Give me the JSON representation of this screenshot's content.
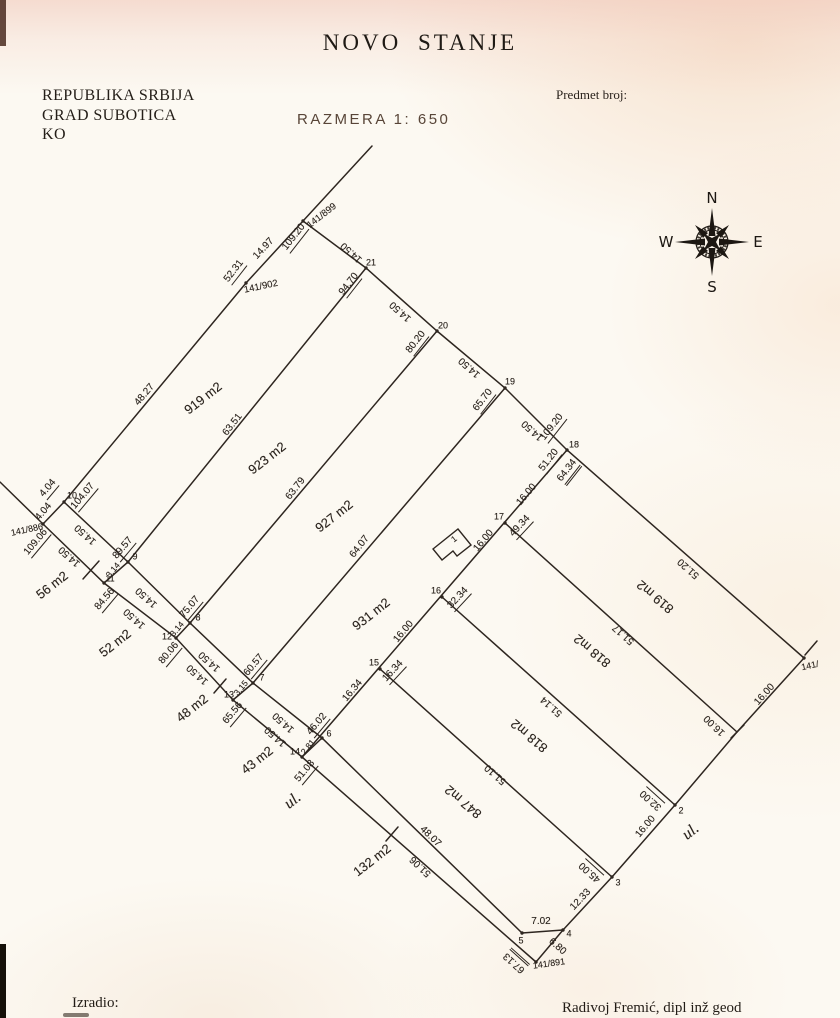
{
  "header": {
    "title": "NOVO STANJE",
    "region_lines": [
      "REPUBLIKA SRBIJA",
      "GRAD SUBOTICA",
      "KO"
    ],
    "scale_label": "RAZMERA 1:  650",
    "case_label": "Predmet broj:"
  },
  "compass": {
    "n": "N",
    "e": "E",
    "s": "S",
    "w": "W"
  },
  "footer": {
    "prepared_by_label": "Izradio:",
    "surveyor": "Radivoj Fremić, dipl inž geod"
  },
  "plan": {
    "ink": "#2e2620",
    "segments": [
      {
        "pts": [
          [
            372,
            146
          ],
          [
            303,
            221
          ],
          [
            246,
            283
          ],
          [
            64,
            502
          ]
        ]
      },
      {
        "pts": [
          [
            303,
            221
          ],
          [
            366,
            268
          ],
          [
            437,
            331
          ],
          [
            505,
            388
          ],
          [
            567,
            450
          ],
          [
            804,
            658
          ]
        ]
      },
      {
        "pts": [
          [
            804,
            658
          ],
          [
            737,
            732
          ],
          [
            675,
            805
          ],
          [
            612,
            877
          ],
          [
            563,
            930
          ],
          [
            536,
            962
          ]
        ]
      },
      {
        "pts": [
          [
            522,
            933
          ],
          [
            563,
            930
          ]
        ]
      },
      {
        "pts": [
          [
            366,
            268
          ],
          [
            128,
            562
          ]
        ]
      },
      {
        "pts": [
          [
            437,
            331
          ],
          [
            190,
            623
          ]
        ]
      },
      {
        "pts": [
          [
            505,
            388
          ],
          [
            253,
            683
          ]
        ]
      },
      {
        "pts": [
          [
            567,
            450
          ],
          [
            302,
            757
          ]
        ]
      },
      {
        "pts": [
          [
            505,
            523
          ],
          [
            737,
            732
          ]
        ]
      },
      {
        "pts": [
          [
            442,
            597
          ],
          [
            675,
            805
          ]
        ]
      },
      {
        "pts": [
          [
            380,
            669
          ],
          [
            612,
            877
          ]
        ]
      },
      {
        "pts": [
          [
            64,
            502
          ],
          [
            128,
            562
          ],
          [
            190,
            623
          ],
          [
            253,
            683
          ],
          [
            322,
            738
          ],
          [
            522,
            933
          ]
        ]
      },
      {
        "pts": [
          [
            0,
            482
          ],
          [
            43,
            524
          ],
          [
            104,
            583
          ],
          [
            176,
            638
          ],
          [
            233,
            700
          ],
          [
            302,
            757
          ],
          [
            536,
            962
          ]
        ]
      },
      {
        "pts": [
          [
            64,
            502
          ],
          [
            43,
            524
          ]
        ]
      },
      {
        "pts": [
          [
            128,
            562
          ],
          [
            104,
            583
          ]
        ]
      },
      {
        "pts": [
          [
            190,
            623
          ],
          [
            176,
            638
          ]
        ]
      },
      {
        "pts": [
          [
            253,
            683
          ],
          [
            233,
            700
          ]
        ]
      },
      {
        "pts": [
          [
            322,
            738
          ],
          [
            302,
            757
          ]
        ]
      }
    ],
    "ticks": [
      [
        99,
        561,
        83,
        579
      ],
      [
        226,
        679,
        214,
        693
      ],
      [
        398,
        827,
        386,
        841
      ],
      [
        817,
        641,
        805,
        655
      ],
      [
        744,
        725,
        731,
        738
      ]
    ],
    "points": [
      [
        303,
        221
      ],
      [
        246,
        283
      ],
      [
        366,
        268
      ],
      [
        437,
        331
      ],
      [
        505,
        388
      ],
      [
        567,
        450
      ],
      [
        505,
        523
      ],
      [
        442,
        597
      ],
      [
        380,
        669
      ],
      [
        302,
        757
      ],
      [
        233,
        700
      ],
      [
        176,
        638
      ],
      [
        104,
        583
      ],
      [
        64,
        502
      ],
      [
        43,
        524
      ],
      [
        128,
        562
      ],
      [
        190,
        623
      ],
      [
        253,
        683
      ],
      [
        322,
        738
      ],
      [
        522,
        933
      ],
      [
        563,
        930
      ],
      [
        536,
        962
      ],
      [
        612,
        877
      ],
      [
        675,
        805
      ],
      [
        804,
        658
      ]
    ],
    "house": {
      "points": "433,549 458,529 471,545 457,556 453,551 442,560",
      "label": "1"
    },
    "labels": [
      {
        "t": "141/899",
        "x": 322,
        "y": 216,
        "r": -38,
        "s": 9.5
      },
      {
        "t": "109.20",
        "x": 295,
        "y": 238,
        "r": -52,
        "u": 1
      },
      {
        "t": "14.97",
        "x": 264,
        "y": 249,
        "r": -47
      },
      {
        "t": "52.31",
        "x": 235,
        "y": 272,
        "r": -52,
        "u": 1
      },
      {
        "t": "141/902",
        "x": 261,
        "y": 287,
        "r": -12,
        "s": 9.5
      },
      {
        "t": "14.50",
        "x": 352,
        "y": 252,
        "r": -138
      },
      {
        "t": "21",
        "x": 371,
        "y": 263,
        "r": 0,
        "s": 9
      },
      {
        "t": "94.70",
        "x": 350,
        "y": 285,
        "r": -52,
        "u": 1
      },
      {
        "t": "14.50",
        "x": 401,
        "y": 311,
        "r": -138
      },
      {
        "t": "20",
        "x": 443,
        "y": 326,
        "r": 0,
        "s": 9
      },
      {
        "t": "80.20",
        "x": 417,
        "y": 343,
        "r": -52,
        "u": 1
      },
      {
        "t": "14.50",
        "x": 470,
        "y": 367,
        "r": -138
      },
      {
        "t": "19",
        "x": 510,
        "y": 382,
        "r": 0,
        "s": 9
      },
      {
        "t": "65.70",
        "x": 484,
        "y": 401,
        "r": -52,
        "u": 1
      },
      {
        "t": "14.50",
        "x": 533,
        "y": 430,
        "r": -138
      },
      {
        "t": "109.20",
        "x": 553,
        "y": 428,
        "r": -52,
        "u": 1
      },
      {
        "t": "18",
        "x": 574,
        "y": 445,
        "r": 0,
        "s": 9
      },
      {
        "t": "51.20",
        "x": 550,
        "y": 461,
        "r": -52,
        "u": 1
      },
      {
        "t": "64.34",
        "x": 569,
        "y": 472,
        "r": -52,
        "u": 2
      },
      {
        "t": "48.27",
        "x": 145,
        "y": 395,
        "r": -50
      },
      {
        "t": "919 m2",
        "x": 203,
        "y": 398,
        "r": -38,
        "s": 13
      },
      {
        "t": "63.51",
        "x": 233,
        "y": 425,
        "r": -52
      },
      {
        "t": "923 m2",
        "x": 267,
        "y": 458,
        "r": -38,
        "s": 13
      },
      {
        "t": "63.79",
        "x": 296,
        "y": 489,
        "r": -52
      },
      {
        "t": "927 m2",
        "x": 334,
        "y": 516,
        "r": -38,
        "s": 13
      },
      {
        "t": "64.07",
        "x": 360,
        "y": 547,
        "r": -52
      },
      {
        "t": "931 m2",
        "x": 371,
        "y": 614,
        "r": -38,
        "s": 13
      },
      {
        "t": "10",
        "x": 72,
        "y": 496,
        "r": 0,
        "s": 9
      },
      {
        "t": "4.04",
        "x": 49,
        "y": 489,
        "r": -50,
        "u": 1
      },
      {
        "t": "104.07",
        "x": 84,
        "y": 497,
        "r": -50,
        "u": 1
      },
      {
        "t": "4.04",
        "x": 44,
        "y": 512,
        "r": -50
      },
      {
        "t": "141/886",
        "x": 27,
        "y": 530,
        "r": -12,
        "s": 9
      },
      {
        "t": "109.06",
        "x": 37,
        "y": 543,
        "r": -50,
        "u": 1
      },
      {
        "t": "14.50",
        "x": 86,
        "y": 534,
        "r": -138
      },
      {
        "t": "14.50",
        "x": 70,
        "y": 556,
        "r": -138
      },
      {
        "t": "89.57",
        "x": 124,
        "y": 549,
        "r": -50,
        "u": 1
      },
      {
        "t": "9",
        "x": 135,
        "y": 557,
        "r": 0,
        "s": 9
      },
      {
        "t": "3.14",
        "x": 113,
        "y": 570,
        "r": -50,
        "s": 8.5
      },
      {
        "t": "11",
        "x": 110,
        "y": 579,
        "r": 0,
        "s": 9
      },
      {
        "t": "84.56",
        "x": 106,
        "y": 600,
        "r": -50,
        "u": 1
      },
      {
        "t": "56 m2",
        "x": 52,
        "y": 585,
        "r": -38,
        "s": 13
      },
      {
        "t": "52 m2",
        "x": 115,
        "y": 643,
        "r": -38,
        "s": 13
      },
      {
        "t": "14.50",
        "x": 147,
        "y": 597,
        "r": -138
      },
      {
        "t": "14.50",
        "x": 135,
        "y": 618,
        "r": -138
      },
      {
        "t": "75.07",
        "x": 191,
        "y": 608,
        "r": -50,
        "u": 1
      },
      {
        "t": "8",
        "x": 198,
        "y": 618,
        "r": 0,
        "s": 9
      },
      {
        "t": "3.14",
        "x": 177,
        "y": 629,
        "r": -50,
        "s": 8.5
      },
      {
        "t": "12",
        "x": 167,
        "y": 637,
        "r": 0,
        "s": 9
      },
      {
        "t": "80.06",
        "x": 170,
        "y": 654,
        "r": -50,
        "u": 1
      },
      {
        "t": "14.50",
        "x": 210,
        "y": 661,
        "r": -138
      },
      {
        "t": "14.50",
        "x": 198,
        "y": 674,
        "r": -138
      },
      {
        "t": "48 m2",
        "x": 192,
        "y": 708,
        "r": -38,
        "s": 13
      },
      {
        "t": "60.57",
        "x": 255,
        "y": 666,
        "r": -50,
        "u": 1
      },
      {
        "t": "7",
        "x": 262,
        "y": 678,
        "r": 0,
        "s": 9
      },
      {
        "t": "3.15",
        "x": 241,
        "y": 688,
        "r": -50,
        "s": 8.5
      },
      {
        "t": "13",
        "x": 229,
        "y": 695,
        "r": 0,
        "s": 9
      },
      {
        "t": "65.56",
        "x": 234,
        "y": 714,
        "r": -50,
        "u": 1
      },
      {
        "t": "14.50",
        "x": 284,
        "y": 722,
        "r": -138
      },
      {
        "t": "14.50",
        "x": 276,
        "y": 736,
        "r": -138
      },
      {
        "t": "43 m2",
        "x": 257,
        "y": 760,
        "r": -38,
        "s": 13
      },
      {
        "t": "46.02",
        "x": 318,
        "y": 725,
        "r": -50,
        "u": 1
      },
      {
        "t": "6",
        "x": 329,
        "y": 734,
        "r": 0,
        "s": 9
      },
      {
        "t": "2.81",
        "x": 308,
        "y": 747,
        "r": -50,
        "s": 8.5
      },
      {
        "t": "14",
        "x": 295,
        "y": 752,
        "r": 0,
        "s": 9
      },
      {
        "t": "51.08",
        "x": 306,
        "y": 772,
        "r": -50,
        "u": 1
      },
      {
        "t": "ul.",
        "x": 293,
        "y": 801,
        "r": -38,
        "s": 16
      },
      {
        "t": "132 m2",
        "x": 372,
        "y": 860,
        "r": -38,
        "s": 13
      },
      {
        "t": "48.07",
        "x": 430,
        "y": 837,
        "r": 44
      },
      {
        "t": "51.06",
        "x": 421,
        "y": 866,
        "r": -136
      },
      {
        "t": "847 m2",
        "x": 463,
        "y": 802,
        "r": -140,
        "s": 13
      },
      {
        "t": "17",
        "x": 499,
        "y": 517,
        "r": 0,
        "s": 9
      },
      {
        "t": "49.34",
        "x": 521,
        "y": 527,
        "r": -47,
        "u": 1
      },
      {
        "t": "16.00",
        "x": 484,
        "y": 541,
        "r": -50
      },
      {
        "t": "16.00",
        "x": 527,
        "y": 495,
        "r": -50
      },
      {
        "t": "16",
        "x": 436,
        "y": 591,
        "r": 0,
        "s": 9
      },
      {
        "t": "32.34",
        "x": 459,
        "y": 599,
        "r": -47,
        "u": 1
      },
      {
        "t": "16.00",
        "x": 404,
        "y": 632,
        "r": -50
      },
      {
        "t": "15",
        "x": 374,
        "y": 663,
        "r": 0,
        "s": 9
      },
      {
        "t": "16.34",
        "x": 394,
        "y": 672,
        "r": -47,
        "u": 1
      },
      {
        "t": "16.34",
        "x": 353,
        "y": 691,
        "r": -50
      },
      {
        "t": "818 m2",
        "x": 592,
        "y": 651,
        "r": -140,
        "s": 13
      },
      {
        "t": "51.14",
        "x": 552,
        "y": 706,
        "r": -138
      },
      {
        "t": "818 m2",
        "x": 529,
        "y": 736,
        "r": -140,
        "s": 13
      },
      {
        "t": "51.10",
        "x": 496,
        "y": 774,
        "r": -138
      },
      {
        "t": "819 m2",
        "x": 655,
        "y": 597,
        "r": -140,
        "s": 13
      },
      {
        "t": "51.20",
        "x": 689,
        "y": 568,
        "r": -138
      },
      {
        "t": "51.17",
        "x": 624,
        "y": 634,
        "r": -138
      },
      {
        "t": "141/",
        "x": 810,
        "y": 666,
        "r": -12,
        "s": 9
      },
      {
        "t": "16.00",
        "x": 765,
        "y": 695,
        "r": -48
      },
      {
        "t": "16.00",
        "x": 715,
        "y": 725,
        "r": -136
      },
      {
        "t": "2",
        "x": 681,
        "y": 811,
        "r": 0,
        "s": 9
      },
      {
        "t": "32.00",
        "x": 652,
        "y": 799,
        "r": -138,
        "u": 1
      },
      {
        "t": "16.00",
        "x": 646,
        "y": 827,
        "r": -50
      },
      {
        "t": "ul.",
        "x": 691,
        "y": 832,
        "r": -38,
        "s": 16
      },
      {
        "t": "3",
        "x": 618,
        "y": 883,
        "r": 0,
        "s": 9
      },
      {
        "t": "45.00",
        "x": 591,
        "y": 871,
        "r": -138,
        "u": 1
      },
      {
        "t": "12.33",
        "x": 581,
        "y": 900,
        "r": -47
      },
      {
        "t": "4",
        "x": 569,
        "y": 934,
        "r": 0,
        "s": 9
      },
      {
        "t": "7.02",
        "x": 541,
        "y": 922,
        "r": 0
      },
      {
        "t": "5",
        "x": 521,
        "y": 941,
        "r": 0,
        "s": 9
      },
      {
        "t": "6.80",
        "x": 557,
        "y": 947,
        "r": 42
      },
      {
        "t": "67.13",
        "x": 516,
        "y": 961,
        "r": -138,
        "u": 2
      },
      {
        "t": "141/891",
        "x": 549,
        "y": 964,
        "r": -8,
        "s": 9
      },
      {
        "t": "1",
        "x": 454,
        "y": 539,
        "r": -38,
        "s": 8.5
      }
    ]
  }
}
